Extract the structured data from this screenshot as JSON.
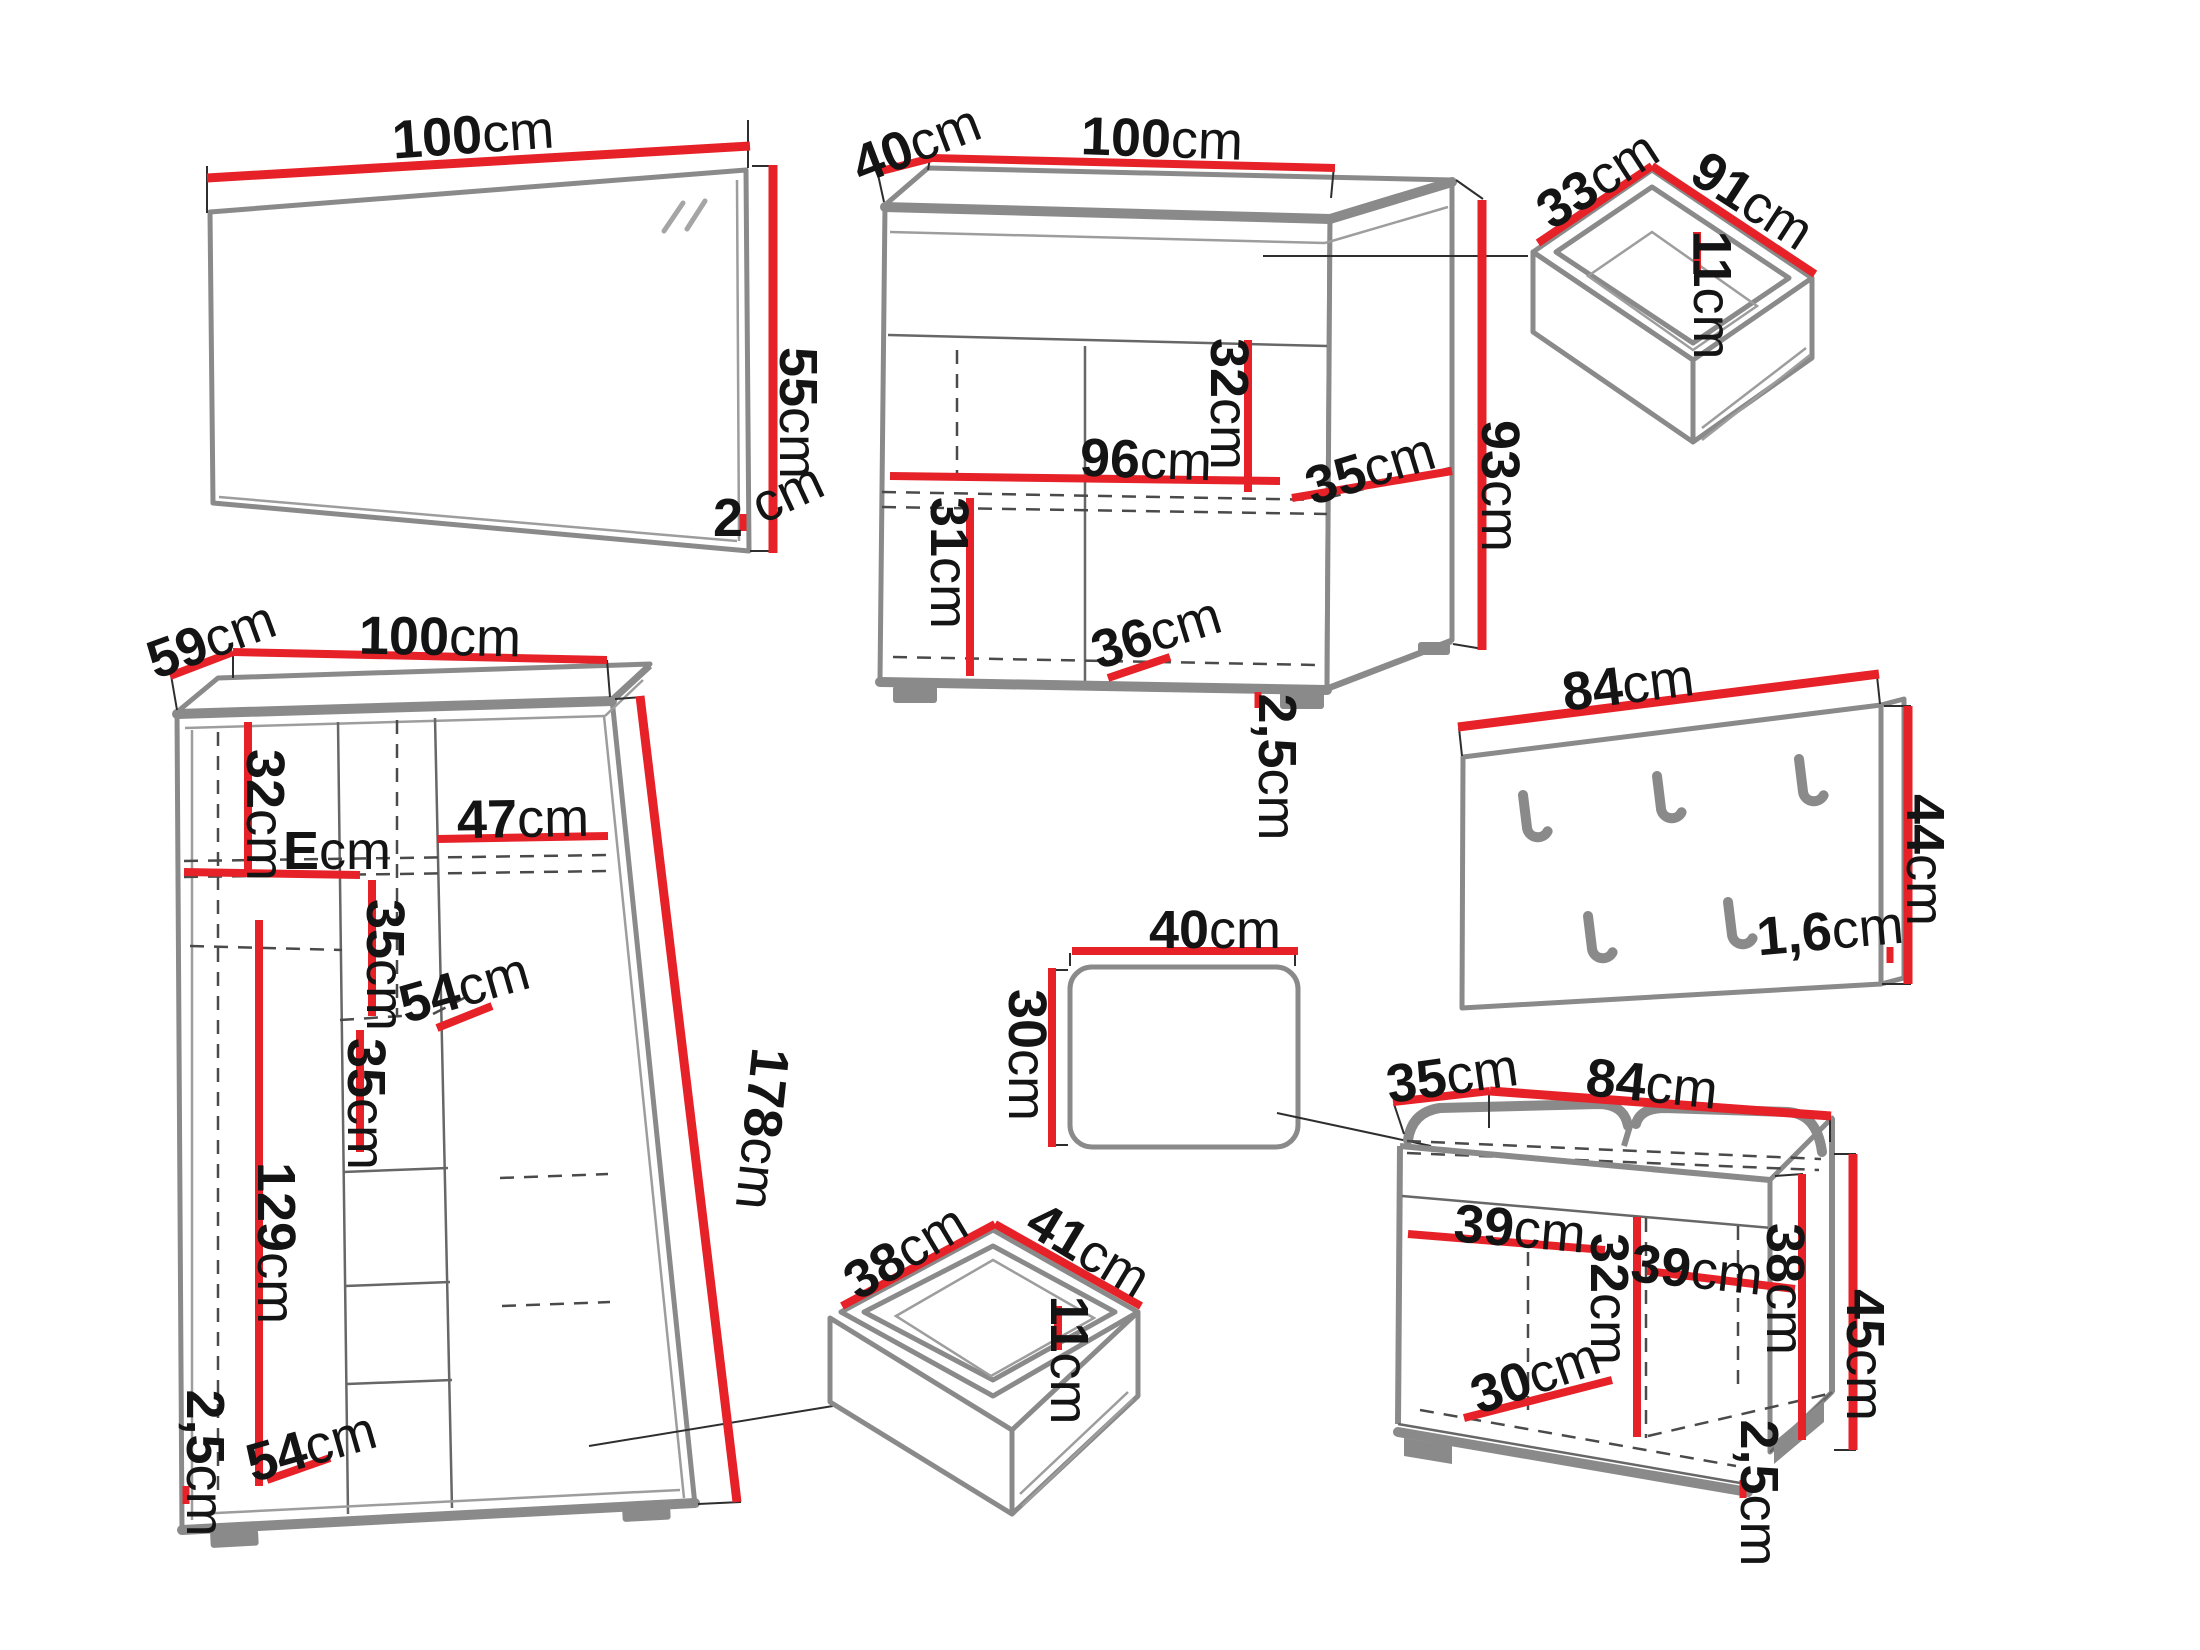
{
  "page": {
    "background": "#ffffff"
  },
  "colors": {
    "dimension_line": "#e62128",
    "furniture_outline": "#8a8a8a",
    "detail_line": "#3c3c3c",
    "label_text": "#141414"
  },
  "figures": {
    "mirror": {
      "width": {
        "v": "100",
        "u": "cm"
      },
      "height": {
        "v": "55",
        "u": "cm"
      },
      "depth": {
        "v": "2",
        "u": "cm"
      }
    },
    "sideboard": {
      "depth": {
        "v": "40",
        "u": "cm"
      },
      "width": {
        "v": "100",
        "u": "cm"
      },
      "upper_inner_height": {
        "v": "32",
        "u": "cm"
      },
      "inner_width": {
        "v": "96",
        "u": "cm"
      },
      "shelf_depth": {
        "v": "35",
        "u": "cm"
      },
      "height": {
        "v": "93",
        "u": "cm"
      },
      "lower_inner_height": {
        "v": "31",
        "u": "cm"
      },
      "bottom_depth": {
        "v": "36",
        "u": "cm"
      },
      "plinth_height": {
        "v": "2,5",
        "u": "cm"
      }
    },
    "drawer_top": {
      "depth": {
        "v": "33",
        "u": "cm"
      },
      "width": {
        "v": "91",
        "u": "cm"
      },
      "height": {
        "v": "11",
        "u": "cm"
      }
    },
    "coat_rack": {
      "width": {
        "v": "84",
        "u": "cm"
      },
      "height": {
        "v": "44",
        "u": "cm"
      },
      "thickness": {
        "v": "1,6",
        "u": "cm"
      }
    },
    "wardrobe": {
      "depth": {
        "v": "59",
        "u": "cm"
      },
      "width": {
        "v": "100",
        "u": "cm"
      },
      "upper_inner_height": {
        "v": "32",
        "u": "cm"
      },
      "left_shelf_width": {
        "v": "E",
        "u": "cm"
      },
      "right_shelf_width": {
        "v": "47",
        "u": "cm"
      },
      "shelf_spacing_upper": {
        "v": "35",
        "u": "cm"
      },
      "shelf_depth": {
        "v": "54",
        "u": "cm"
      },
      "shelf_spacing_lower": {
        "v": "35",
        "u": "cm"
      },
      "hanging_height": {
        "v": "129",
        "u": "cm"
      },
      "bottom_shelf_width": {
        "v": "54",
        "u": "cm"
      },
      "plinth_height": {
        "v": "2,5",
        "u": "cm"
      },
      "height": {
        "v": "178",
        "u": "cm"
      }
    },
    "stool": {
      "width": {
        "v": "40",
        "u": "cm"
      },
      "depth": {
        "v": "30",
        "u": "cm"
      }
    },
    "drawer_bottom": {
      "depth": {
        "v": "38",
        "u": "cm"
      },
      "width": {
        "v": "41",
        "u": "cm"
      },
      "height": {
        "v": "11",
        "u": "cm"
      }
    },
    "bench": {
      "depth": {
        "v": "35",
        "u": "cm"
      },
      "width": {
        "v": "84",
        "u": "cm"
      },
      "left_inner_width": {
        "v": "39",
        "u": "cm"
      },
      "right_inner_width": {
        "v": "39",
        "u": "cm"
      },
      "mid_inner_height": {
        "v": "32",
        "u": "cm"
      },
      "right_inner_height": {
        "v": "38",
        "u": "cm"
      },
      "height": {
        "v": "45",
        "u": "cm"
      },
      "bottom_depth": {
        "v": "30",
        "u": "cm"
      },
      "plinth_height": {
        "v": "2,5",
        "u": "cm"
      }
    }
  }
}
